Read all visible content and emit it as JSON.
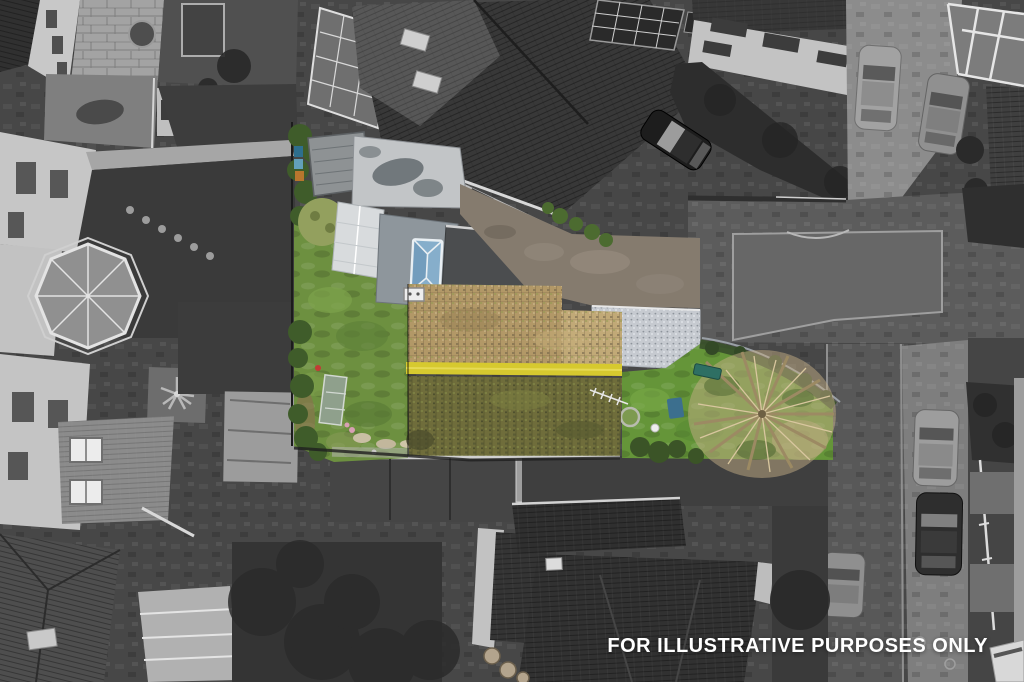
{
  "watermark": {
    "label": "FOR ILLUSTRATIVE PURPOSES ONLY",
    "color": "#ffffff"
  },
  "scene": {
    "type": "aerial-drone-photo",
    "highlighted_area": "central property shown in colour, surroundings desaturated",
    "palette": {
      "lawn": "#6d9040",
      "lawn_right": "#659539",
      "hedge": "#3f5c2a",
      "olive": "#93a05e",
      "moss_upper": "#b29867",
      "moss_upper_right": "#c2aa78",
      "moss_ridge": "#d6c92f",
      "moss_lower": "#6f6d3b",
      "skylight": "#86aecb",
      "flat_roof": "#8e969c",
      "lean_to": "#c2c5c7",
      "greenhouse": "#d8dbdd",
      "shed": "#8e9294",
      "gravel": "#c6cad0",
      "driveway": "#857b6e",
      "tree": "#c3ad85",
      "bench": "#2e6f63",
      "blue_item": "#3c6f8e",
      "cold_frame": "#8fa08c",
      "flowers": "#d8a0b4",
      "road": "#5c5c5c",
      "pavement": "#7e7e7e"
    }
  }
}
